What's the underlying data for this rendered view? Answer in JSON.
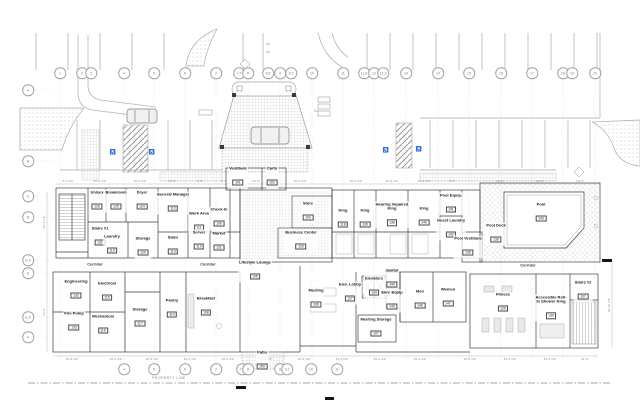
{
  "plan": {
    "property_line_label": "PROPERTY LINE",
    "corridor_labels": [
      {
        "text": "Corridor",
        "x": 95,
        "y": 264
      },
      {
        "text": "Corridor",
        "x": 208,
        "y": 264
      },
      {
        "text": "Corridor",
        "x": 528,
        "y": 265
      }
    ],
    "rooms": [
      {
        "name": "Vestibule",
        "number": "101",
        "x": 238,
        "y": 177
      },
      {
        "name": "Carts",
        "number": "102",
        "x": 272,
        "y": 177
      },
      {
        "name": "Store",
        "number": "104",
        "x": 308,
        "y": 212
      },
      {
        "name": "Business Center",
        "number": "103",
        "x": 301,
        "y": 241
      },
      {
        "name": "Stairs #1",
        "number": "131",
        "x": 100,
        "y": 237
      },
      {
        "name": "Unisex",
        "number": "126",
        "x": 97,
        "y": 201
      },
      {
        "name": "Breakroom",
        "number": "125",
        "x": 116,
        "y": 201
      },
      {
        "name": "Dryer",
        "number": "124",
        "x": 142,
        "y": 201
      },
      {
        "name": "General Manager",
        "number": "112",
        "x": 173,
        "y": 203
      },
      {
        "name": "Work Area",
        "number": "111",
        "x": 199,
        "y": 222
      },
      {
        "name": "Check-In",
        "number": "109",
        "x": 219,
        "y": 218
      },
      {
        "name": "Laundry",
        "number": "119",
        "x": 112,
        "y": 245
      },
      {
        "name": "Storage",
        "number": "120",
        "x": 143,
        "y": 247
      },
      {
        "name": "Sales",
        "number": "113",
        "x": 173,
        "y": 246
      },
      {
        "name": "Server",
        "number": "110",
        "x": 199,
        "y": 241
      },
      {
        "name": "Market",
        "number": "121",
        "x": 219,
        "y": 242
      },
      {
        "name": "King",
        "number": "118",
        "x": 343,
        "y": 219
      },
      {
        "name": "King",
        "number": "139",
        "x": 365,
        "y": 219
      },
      {
        "name": "Hearing Impaired King",
        "number": "138",
        "x": 392,
        "y": 215
      },
      {
        "name": "King",
        "number": "140",
        "x": 424,
        "y": 217
      },
      {
        "name": "Pool Equip.",
        "number": "141",
        "x": 451,
        "y": 204
      },
      {
        "name": "Guest Laundry",
        "number": "142",
        "x": 451,
        "y": 229
      },
      {
        "name": "Pool Vestibule",
        "number": "135",
        "x": 468,
        "y": 247
      },
      {
        "name": "Pool Deck",
        "number": "136",
        "x": 496,
        "y": 234
      },
      {
        "name": "Pool",
        "number": "143",
        "x": 541,
        "y": 213
      },
      {
        "name": "Engineering",
        "number": "132",
        "x": 76,
        "y": 290
      },
      {
        "name": "Electrical",
        "number": "115",
        "x": 107,
        "y": 292
      },
      {
        "name": "Fire Pump",
        "number": "133",
        "x": 74,
        "y": 322
      },
      {
        "name": "Mechanical",
        "number": "116",
        "x": 103,
        "y": 325
      },
      {
        "name": "Storage",
        "number": "117",
        "x": 140,
        "y": 318
      },
      {
        "name": "Pantry",
        "number": "114",
        "x": 172,
        "y": 309
      },
      {
        "name": "Breakfast",
        "number": "108",
        "x": 206,
        "y": 307
      },
      {
        "name": "Lifestyle Lounge",
        "number": "105",
        "x": 255,
        "y": 271
      },
      {
        "name": "Meeting",
        "number": "106",
        "x": 316,
        "y": 299
      },
      {
        "name": "Elev. Lobby",
        "number": "127",
        "x": 350,
        "y": 293
      },
      {
        "name": "Elevators",
        "number": "134",
        "x": 374,
        "y": 287
      },
      {
        "name": "Janitor",
        "number": "144",
        "x": 392,
        "y": 279
      },
      {
        "name": "Elev. Equip",
        "number": "145",
        "x": 392,
        "y": 301
      },
      {
        "name": "Men",
        "number": "146",
        "x": 420,
        "y": 300
      },
      {
        "name": "Women",
        "number": "147",
        "x": 448,
        "y": 298
      },
      {
        "name": "Meeting Storage",
        "number": "107",
        "x": 376,
        "y": 328
      },
      {
        "name": "Fitness",
        "number": "129",
        "x": 503,
        "y": 303
      },
      {
        "name": "Accessible Roll-In Shower King",
        "number": "130",
        "x": 551,
        "y": 308
      },
      {
        "name": "Stairs #2",
        "number": "137",
        "x": 583,
        "y": 291
      },
      {
        "name": "Patio",
        "number": "150",
        "x": 262,
        "y": 361
      }
    ],
    "grid": {
      "top_y": 73,
      "bottom_y": 369,
      "left_x": 28,
      "top": [
        {
          "label": "1",
          "x": 60
        },
        {
          "label": "2",
          "x": 82
        },
        {
          "label": "3",
          "x": 91
        },
        {
          "label": "4",
          "x": 124
        },
        {
          "label": "5",
          "x": 154
        },
        {
          "label": "6",
          "x": 185
        },
        {
          "label": "7",
          "x": 216
        },
        {
          "label": "7.7",
          "x": 239
        },
        {
          "label": "8",
          "x": 248
        },
        {
          "label": "8.5",
          "x": 268
        },
        {
          "label": "9",
          "x": 280
        },
        {
          "label": "9.2",
          "x": 291
        },
        {
          "label": "10",
          "x": 312
        },
        {
          "label": "11",
          "x": 343
        },
        {
          "label": "11.8",
          "x": 364
        },
        {
          "label": "12",
          "x": 374
        },
        {
          "label": "12.3",
          "x": 383
        },
        {
          "label": "13",
          "x": 406
        },
        {
          "label": "14",
          "x": 438
        },
        {
          "label": "15",
          "x": 469
        },
        {
          "label": "16",
          "x": 501
        },
        {
          "label": "17",
          "x": 532
        },
        {
          "label": "18",
          "x": 563
        },
        {
          "label": "19",
          "x": 572
        },
        {
          "label": "20",
          "x": 595
        }
      ],
      "bottom": [
        {
          "label": "4",
          "x": 124
        },
        {
          "label": "5",
          "x": 154
        },
        {
          "label": "6",
          "x": 185
        },
        {
          "label": "7",
          "x": 216
        },
        {
          "label": "7.7",
          "x": 242
        },
        {
          "label": "8",
          "x": 248
        },
        {
          "label": "9",
          "x": 280
        },
        {
          "label": "9.2",
          "x": 287
        },
        {
          "label": "10",
          "x": 311
        },
        {
          "label": "11",
          "x": 337
        }
      ],
      "left": [
        {
          "label": "A",
          "y": 90
        },
        {
          "label": "B",
          "y": 161
        },
        {
          "label": "C",
          "y": 196
        },
        {
          "label": "D",
          "y": 217
        },
        {
          "label": "D.4",
          "y": 260
        },
        {
          "label": "E",
          "y": 273
        },
        {
          "label": "E.6",
          "y": 317
        },
        {
          "label": "F",
          "y": 337
        }
      ]
    },
    "dims": {
      "top": [
        {
          "text": "8'-4 1/4\"",
          "x": 68
        },
        {
          "text": "10'-4 1/2\"",
          "x": 100
        },
        {
          "text": "10'-4 1/2\"",
          "x": 140
        },
        {
          "text": "12'-8\"",
          "x": 172
        },
        {
          "text": "6'-0\"",
          "x": 200
        },
        {
          "text": "8'-0\"",
          "x": 224
        },
        {
          "text": "16'-0\"",
          "x": 256
        },
        {
          "text": "10'-4 1/2\"",
          "x": 300
        },
        {
          "text": "10'-4 1/2\"",
          "x": 356
        },
        {
          "text": "10'-4 1/2\"",
          "x": 392
        },
        {
          "text": "10'-4 1/2\"",
          "x": 424
        },
        {
          "text": "8'-8\"",
          "x": 452
        },
        {
          "text": "12'-0\"",
          "x": 500
        },
        {
          "text": "30'-0\"",
          "x": 540
        },
        {
          "text": "10'-0\"",
          "x": 580
        }
      ],
      "bottom": [
        {
          "text": "19'-4 1/2\"",
          "x": 72
        },
        {
          "text": "10'-4 1/2\"",
          "x": 116
        },
        {
          "text": "10'-4 1/2\"",
          "x": 152
        },
        {
          "text": "10'-4 1/2\"",
          "x": 190
        },
        {
          "text": "10'-4 1/2\"",
          "x": 228
        },
        {
          "text": "10'-4 1/2\"",
          "x": 266
        },
        {
          "text": "10'-4 1/2\"",
          "x": 304
        },
        {
          "text": "10'-4 1/2\"",
          "x": 342
        },
        {
          "text": "10'-4 1/2\"",
          "x": 380
        },
        {
          "text": "19'-4 1/2\"",
          "x": 420
        },
        {
          "text": "10'-4 1/2\"",
          "x": 470
        },
        {
          "text": "10'-4 1/2\"",
          "x": 510
        },
        {
          "text": "10'-4 1/2\"",
          "x": 550
        },
        {
          "text": "11'-0\"",
          "x": 585
        }
      ],
      "left": [
        {
          "text": "30'-4 1/2\"",
          "y": 222
        },
        {
          "text": "16'-8\"",
          "y": 312
        }
      ],
      "right": [
        {
          "text": "29'-10 1/2\"",
          "y": 305
        }
      ]
    },
    "markers": {
      "accessible_symbol": "♿",
      "accessible_positions": [
        {
          "x": 113,
          "y": 153
        },
        {
          "x": 152,
          "y": 153
        },
        {
          "x": 386,
          "y": 151
        },
        {
          "x": 419,
          "y": 150
        }
      ],
      "arrows": [
        {
          "glyph": "⇨",
          "x": 268,
          "y": 45
        },
        {
          "glyph": "⇦",
          "x": 268,
          "y": 53
        },
        {
          "glyph": "⇦",
          "x": 316,
          "y": 112
        }
      ]
    }
  }
}
